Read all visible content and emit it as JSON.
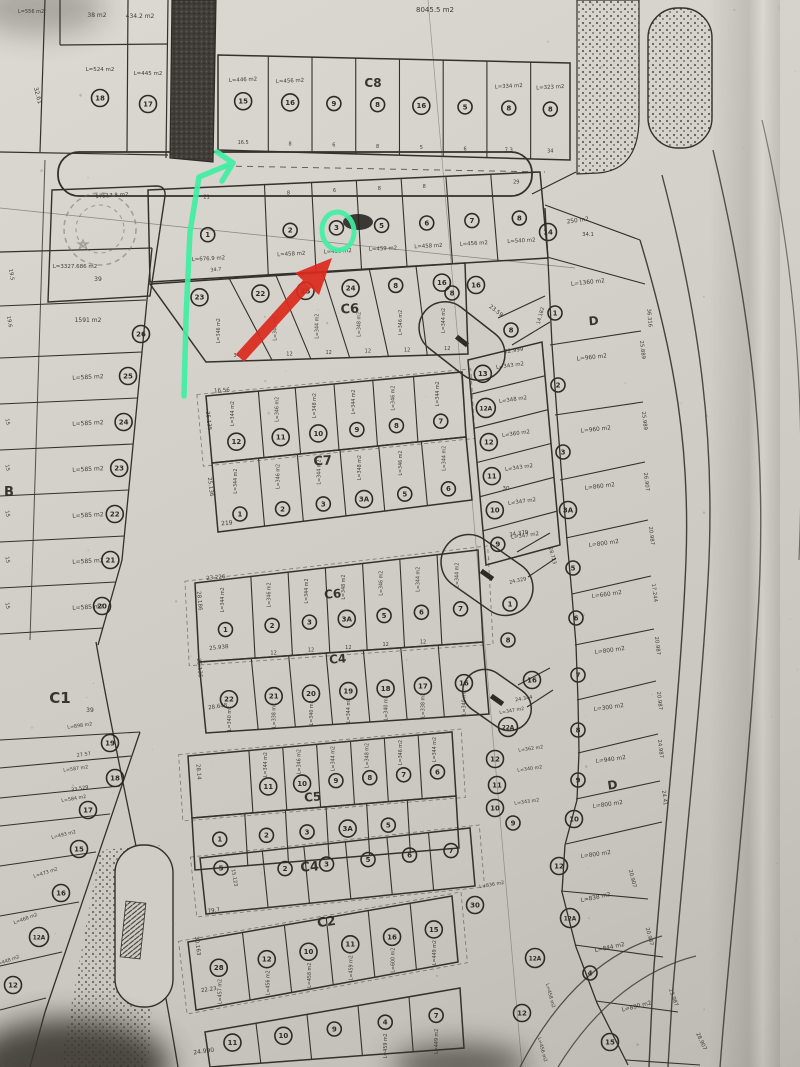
{
  "photo": {
    "description": "Photographed black-and-white cadastral subdivision plan (land parcel map) with hand-drawn marker annotations",
    "paper": "#d2cfc8",
    "ink": "#34302a"
  },
  "annotations": {
    "green": "#3fefa3",
    "red": "#dc2a1e",
    "green_arrow": "hand-drawn green line with arrow hook running along the left of the upper block",
    "green_circle": "green ring highlighting circled parcel number 3",
    "red_arrow": "thick red arrow pointing up-right at parcel 3 of the upper row"
  },
  "top": {
    "area": "8045.5 m2"
  },
  "top_left": {
    "a1": "38 m2",
    "a2": "434.2 m2",
    "a3": "L=524 m2",
    "a4": "L=445 m2",
    "a5": "L=556 m2",
    "m": "32.61",
    "n1": "18",
    "n2": "17"
  },
  "stamp": {
    "area": "17517.8 m2"
  },
  "labels": {
    "c8": "C8",
    "c6a": "C6",
    "c7": "C7",
    "c6b": "C6",
    "c4a": "C4",
    "c5": "C5",
    "c4b": "C4",
    "c2": "C2",
    "c1": "C1",
    "d": "D",
    "b": "B"
  },
  "strips": {
    "c8_top": {
      "nums": [
        "15",
        "16",
        "9",
        "8",
        "16",
        "5",
        "8",
        "8"
      ],
      "areas": {
        "0": "L=446 m2",
        "1": "L=456 m2",
        "6": "L=334 m2",
        "7": "L=323 m2"
      },
      "widths": {
        "0": "16.5",
        "1": "8",
        "2": "6",
        "3": "8",
        "4": "5",
        "5": "6",
        "6": "7.3",
        "7": "34"
      }
    },
    "r1": {
      "nums": [
        "1",
        "2",
        "3",
        "5",
        "6",
        "7",
        "8"
      ],
      "areas": [
        "L=676.9 m2",
        "L=458 m2",
        "L=458 m2",
        "L=459 m2",
        "L=458 m2",
        "L=456 m2",
        "L=540 m2"
      ],
      "widths": {
        "0": "21",
        "1": "8",
        "2": "6",
        "3": "8",
        "4": "8",
        "6": "29"
      },
      "m": "34.7"
    },
    "c6_upper": {
      "nums": [
        "23",
        "22",
        "25",
        "24",
        "8",
        "16"
      ],
      "areas": [
        "L=346 m2",
        "L=348 m2",
        "L=344 m2",
        "L=348 m2",
        "L=346 m2",
        "L=344 m2"
      ],
      "widths": {
        "0": "34",
        "1": "12",
        "2": "12",
        "3": "12",
        "4": "12",
        "5": "12"
      }
    },
    "c7": {
      "top_nums": [
        "12",
        "11",
        "10",
        "9",
        "8",
        "7"
      ],
      "top_areas": [
        "L=344 m2",
        "L=346 m2",
        "L=348 m2",
        "L=344 m2",
        "L=346 m2",
        "L=344 m2"
      ],
      "bottom_nums": [
        "1",
        "2",
        "3",
        "3A",
        "5",
        "6"
      ],
      "bottom_areas": [
        "L=344 m2",
        "L=346 m2",
        "L=344 m2",
        "L=348 m2",
        "L=346 m2",
        "L=344 m2"
      ]
    },
    "c6_lower": {
      "nums": [
        "1",
        "2",
        "3",
        "3A",
        "5",
        "6",
        "7"
      ],
      "areas": [
        "L=344 m2",
        "L=346 m2",
        "L=344 m2",
        "L=348 m2",
        "L=346 m2",
        "L=344 m2",
        "L=344 m2"
      ],
      "widths": {
        "1": "12",
        "2": "12",
        "3": "12",
        "4": "12",
        "5": "12"
      }
    },
    "c4_upper": {
      "nums": [
        "22",
        "21",
        "20",
        "19",
        "18",
        "17",
        "16"
      ],
      "areas": [
        "L=340 m2",
        "L=338 m2",
        "L=340 m2",
        "L=344 m2",
        "L=340 m2",
        "L=338 m2",
        "L=340 m2"
      ]
    },
    "c5": {
      "top_nums": [
        "",
        "11",
        "10",
        "9",
        "8",
        "7",
        "6"
      ],
      "top_areas": [
        "",
        "L=344 m2",
        "L=346 m2",
        "L=344 m2",
        "L=348 m2",
        "L=346 m2",
        "L=344 m2"
      ],
      "bottom_nums": [
        "1",
        "2",
        "3",
        "3A",
        "5",
        ""
      ]
    },
    "c4_lower": {
      "nums": [
        "",
        "2",
        "3",
        "5",
        "6",
        "7"
      ],
      "extra_n": "5"
    },
    "c2": {
      "nums": [
        "28",
        "12",
        "10",
        "11",
        "16",
        "15"
      ],
      "areas": [
        "L=457 m2",
        "L=456 m2",
        "L=458 m2",
        "L=459 m2",
        "L=600 m2",
        "L=449 m2"
      ]
    },
    "bottom_row": {
      "nums": [
        "11",
        "10",
        "9",
        "4",
        "7"
      ],
      "areas": {
        "3": "L=459 m2",
        "4": "L=449 m2"
      }
    }
  },
  "mid": {
    "nums": [
      "13",
      "12A",
      "12",
      "11",
      "10",
      "9"
    ],
    "areas": [
      "L=343 m2",
      "L=348 m2",
      "L=360 m2",
      "L=343 m2",
      "L=347 m2",
      "L=347 m2"
    ],
    "meas": {
      "m22999": "22.999",
      "m2359": "23.59",
      "m14182": "14.182",
      "m34379": "34.379",
      "m30": "30",
      "m24329": "24.329",
      "m28723": "28.723",
      "m24344": "24.344"
    },
    "cluster": [
      {
        "n": "8"
      },
      {
        "n": "16"
      },
      {
        "n": "8"
      },
      {
        "n": "1"
      },
      {
        "n": "8"
      },
      {
        "n": "16"
      },
      {
        "n": "22A",
        "a": "L=347 m2"
      },
      {
        "n": "12",
        "a": "L=362 m2"
      },
      {
        "n": "11",
        "a": "L=340 m2"
      },
      {
        "n": "10",
        "a": "L=343 m2"
      },
      {
        "n": "9"
      }
    ],
    "bottom": [
      {
        "n": "30",
        "a": "L=836 m2"
      },
      {
        "n": "12A",
        "a": "L=458 m2"
      },
      {
        "n": "12",
        "a": "L=456 m2"
      }
    ]
  },
  "d_col": {
    "items": [
      {
        "n": "14",
        "a": "250 m2",
        "m": "34.1",
        "e": "36.316"
      },
      {
        "n": "1",
        "a": "L=1360 m2"
      },
      {
        "n": "2",
        "a": "L=960 m2",
        "e": "25.889"
      },
      {
        "n": "3",
        "a": "L=960 m2",
        "e": "25.989"
      },
      {
        "n": "3A",
        "a": "L=860 m2",
        "e": "26.907"
      },
      {
        "n": "5",
        "a": "L=800 m2",
        "e": "20.987"
      },
      {
        "n": "6",
        "a": "L=660 m2",
        "e": "17.244"
      },
      {
        "n": "7",
        "a": "L=800 m2",
        "e": "20.987"
      },
      {
        "n": "8",
        "a": "L=300 m2",
        "e": "20.987"
      },
      {
        "n": "9",
        "a": "L=940 m2",
        "e": "24.987"
      },
      {
        "n": "10",
        "a": "L=800 m2",
        "e": "24.41"
      },
      {
        "n": "12",
        "a": "L=800 m2",
        "e": "20.907"
      },
      {
        "n": "12A",
        "a": "L=838 m2",
        "e": "20.987"
      },
      {
        "n": "4",
        "a": "L=844 m2",
        "e": "23.987"
      },
      {
        "n": "15",
        "a": "L=890 m2",
        "e": "28.907"
      }
    ]
  },
  "c1": {
    "header_area": "L=3327.686 m2",
    "header_n": "39",
    "p1591": "1591 m2",
    "n26": "26",
    "repeat_area": "L=585 m2",
    "nums": [
      "25",
      "24",
      "23",
      "22",
      "21",
      "20"
    ],
    "big_n": "39",
    "lower": [
      {
        "n": "19",
        "a": "L=898 m2",
        "m": "27.57"
      },
      {
        "n": "18",
        "a": "L=587 m2",
        "m": "33.529"
      },
      {
        "n": "17",
        "a": "L=584 m2"
      },
      {
        "n": "15",
        "a": "L=493 m2"
      },
      {
        "n": "16",
        "a": "L=473 m2"
      },
      {
        "n": "12A",
        "a": "L=468 m2"
      },
      {
        "n": "12",
        "a": "L=448 m2"
      }
    ],
    "left_top": [
      "19.5",
      "19.6"
    ],
    "left_w": "15"
  },
  "meas": {
    "m15123": "15.123",
    "m24990": "24.990",
    "m30163": "30.163",
    "m797": "79.7",
    "m2223": "22.23",
    "m23226": "23.226",
    "m28186": "28.186",
    "m25938": "25.938",
    "m25136": "25.136",
    "m28648": "28.648",
    "m1656": "16.56",
    "m25135": "25.135",
    "m25136b": "25.136",
    "m219": "219",
    "m2814": "28.14"
  }
}
